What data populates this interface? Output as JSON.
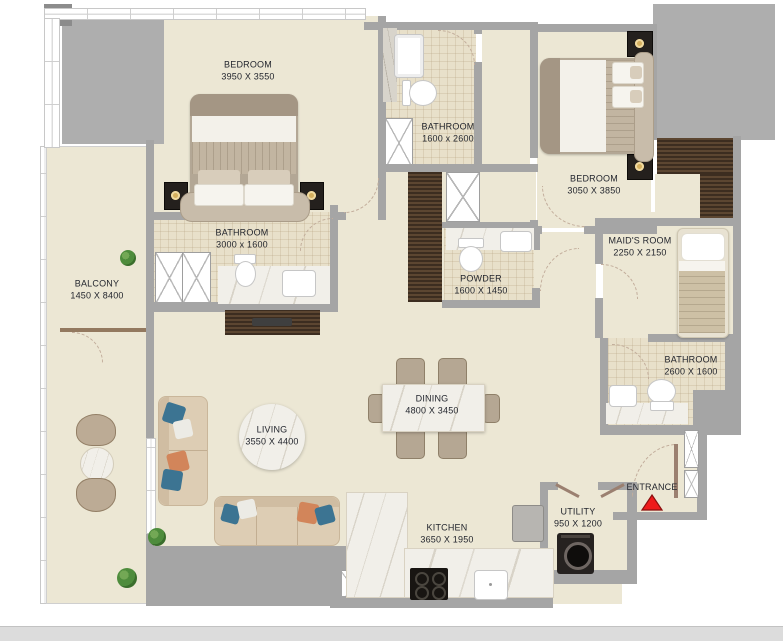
{
  "colors": {
    "floor": "#ece7d4",
    "tile": "#e8e0ca",
    "wall": "#a5a5a5",
    "block": "#aeaeae",
    "marble": "#f1efe9",
    "plant": "#4e8c3c",
    "entrance_red": "#ee1b1b",
    "label": "#23262e",
    "page_bar": "#dcdcdc"
  },
  "rooms": [
    {
      "id": "bedroom-1",
      "name": "BEDROOM",
      "dims": "3950 X 3550"
    },
    {
      "id": "bathroom-1",
      "name": "BATHROOM",
      "dims": "1600 x 2600"
    },
    {
      "id": "bedroom-2",
      "name": "BEDROOM",
      "dims": "3050 X 3850"
    },
    {
      "id": "bathroom-2",
      "name": "BATHROOM",
      "dims": "3000 x 1600"
    },
    {
      "id": "powder",
      "name": "POWDER",
      "dims": "1600 X 1450"
    },
    {
      "id": "maids-room",
      "name": "MAID'S ROOM",
      "dims": "2250 X 2150"
    },
    {
      "id": "balcony",
      "name": "BALCONY",
      "dims": "1450 X 8400"
    },
    {
      "id": "bathroom-3",
      "name": "BATHROOM",
      "dims": "2600 X 1600"
    },
    {
      "id": "living",
      "name": "LIVING",
      "dims": "3550 X 4400"
    },
    {
      "id": "dining",
      "name": "DINING",
      "dims": "4800 X 3450"
    },
    {
      "id": "kitchen",
      "name": "KITCHEN",
      "dims": "3650 X 1950"
    },
    {
      "id": "utility",
      "name": "UTILITY",
      "dims": "950 X 1200"
    },
    {
      "id": "entrance",
      "name": "ENTRANCE",
      "dims": ""
    }
  ]
}
